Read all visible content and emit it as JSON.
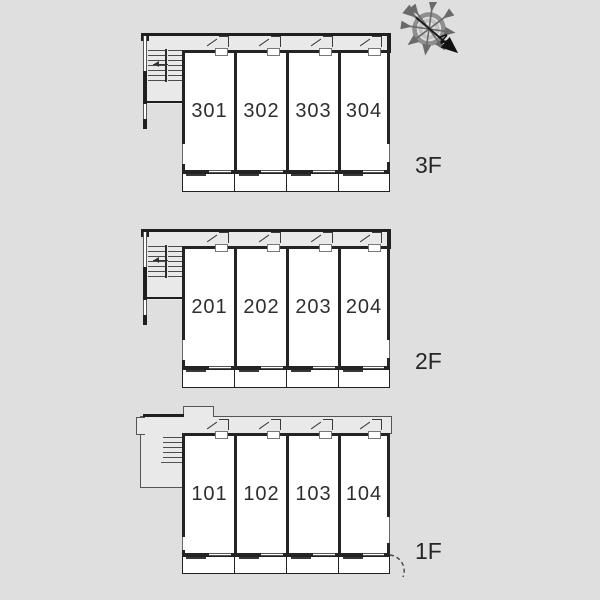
{
  "title": "apartment-building-floor-plans",
  "compass": {
    "north_label": "N"
  },
  "floors": [
    {
      "label": "3F",
      "rooms": [
        "301",
        "302",
        "303",
        "304"
      ]
    },
    {
      "label": "2F",
      "rooms": [
        "201",
        "202",
        "203",
        "204"
      ]
    },
    {
      "label": "1F",
      "rooms": [
        "101",
        "102",
        "103",
        "104"
      ]
    }
  ],
  "colors": {
    "background": "#dfdfdf",
    "corridor_fill": "#e9e9e9",
    "wall": "#1f1f1f",
    "room_fill": "#ffffff",
    "thin_line": "#555555",
    "text": "#262626",
    "compass_ring_outer": "#8f8f8f",
    "compass_ring_inner": "#c2c2c2",
    "compass_spokes": "#6a6a6a",
    "north_arrow": "#1c1c1c"
  }
}
